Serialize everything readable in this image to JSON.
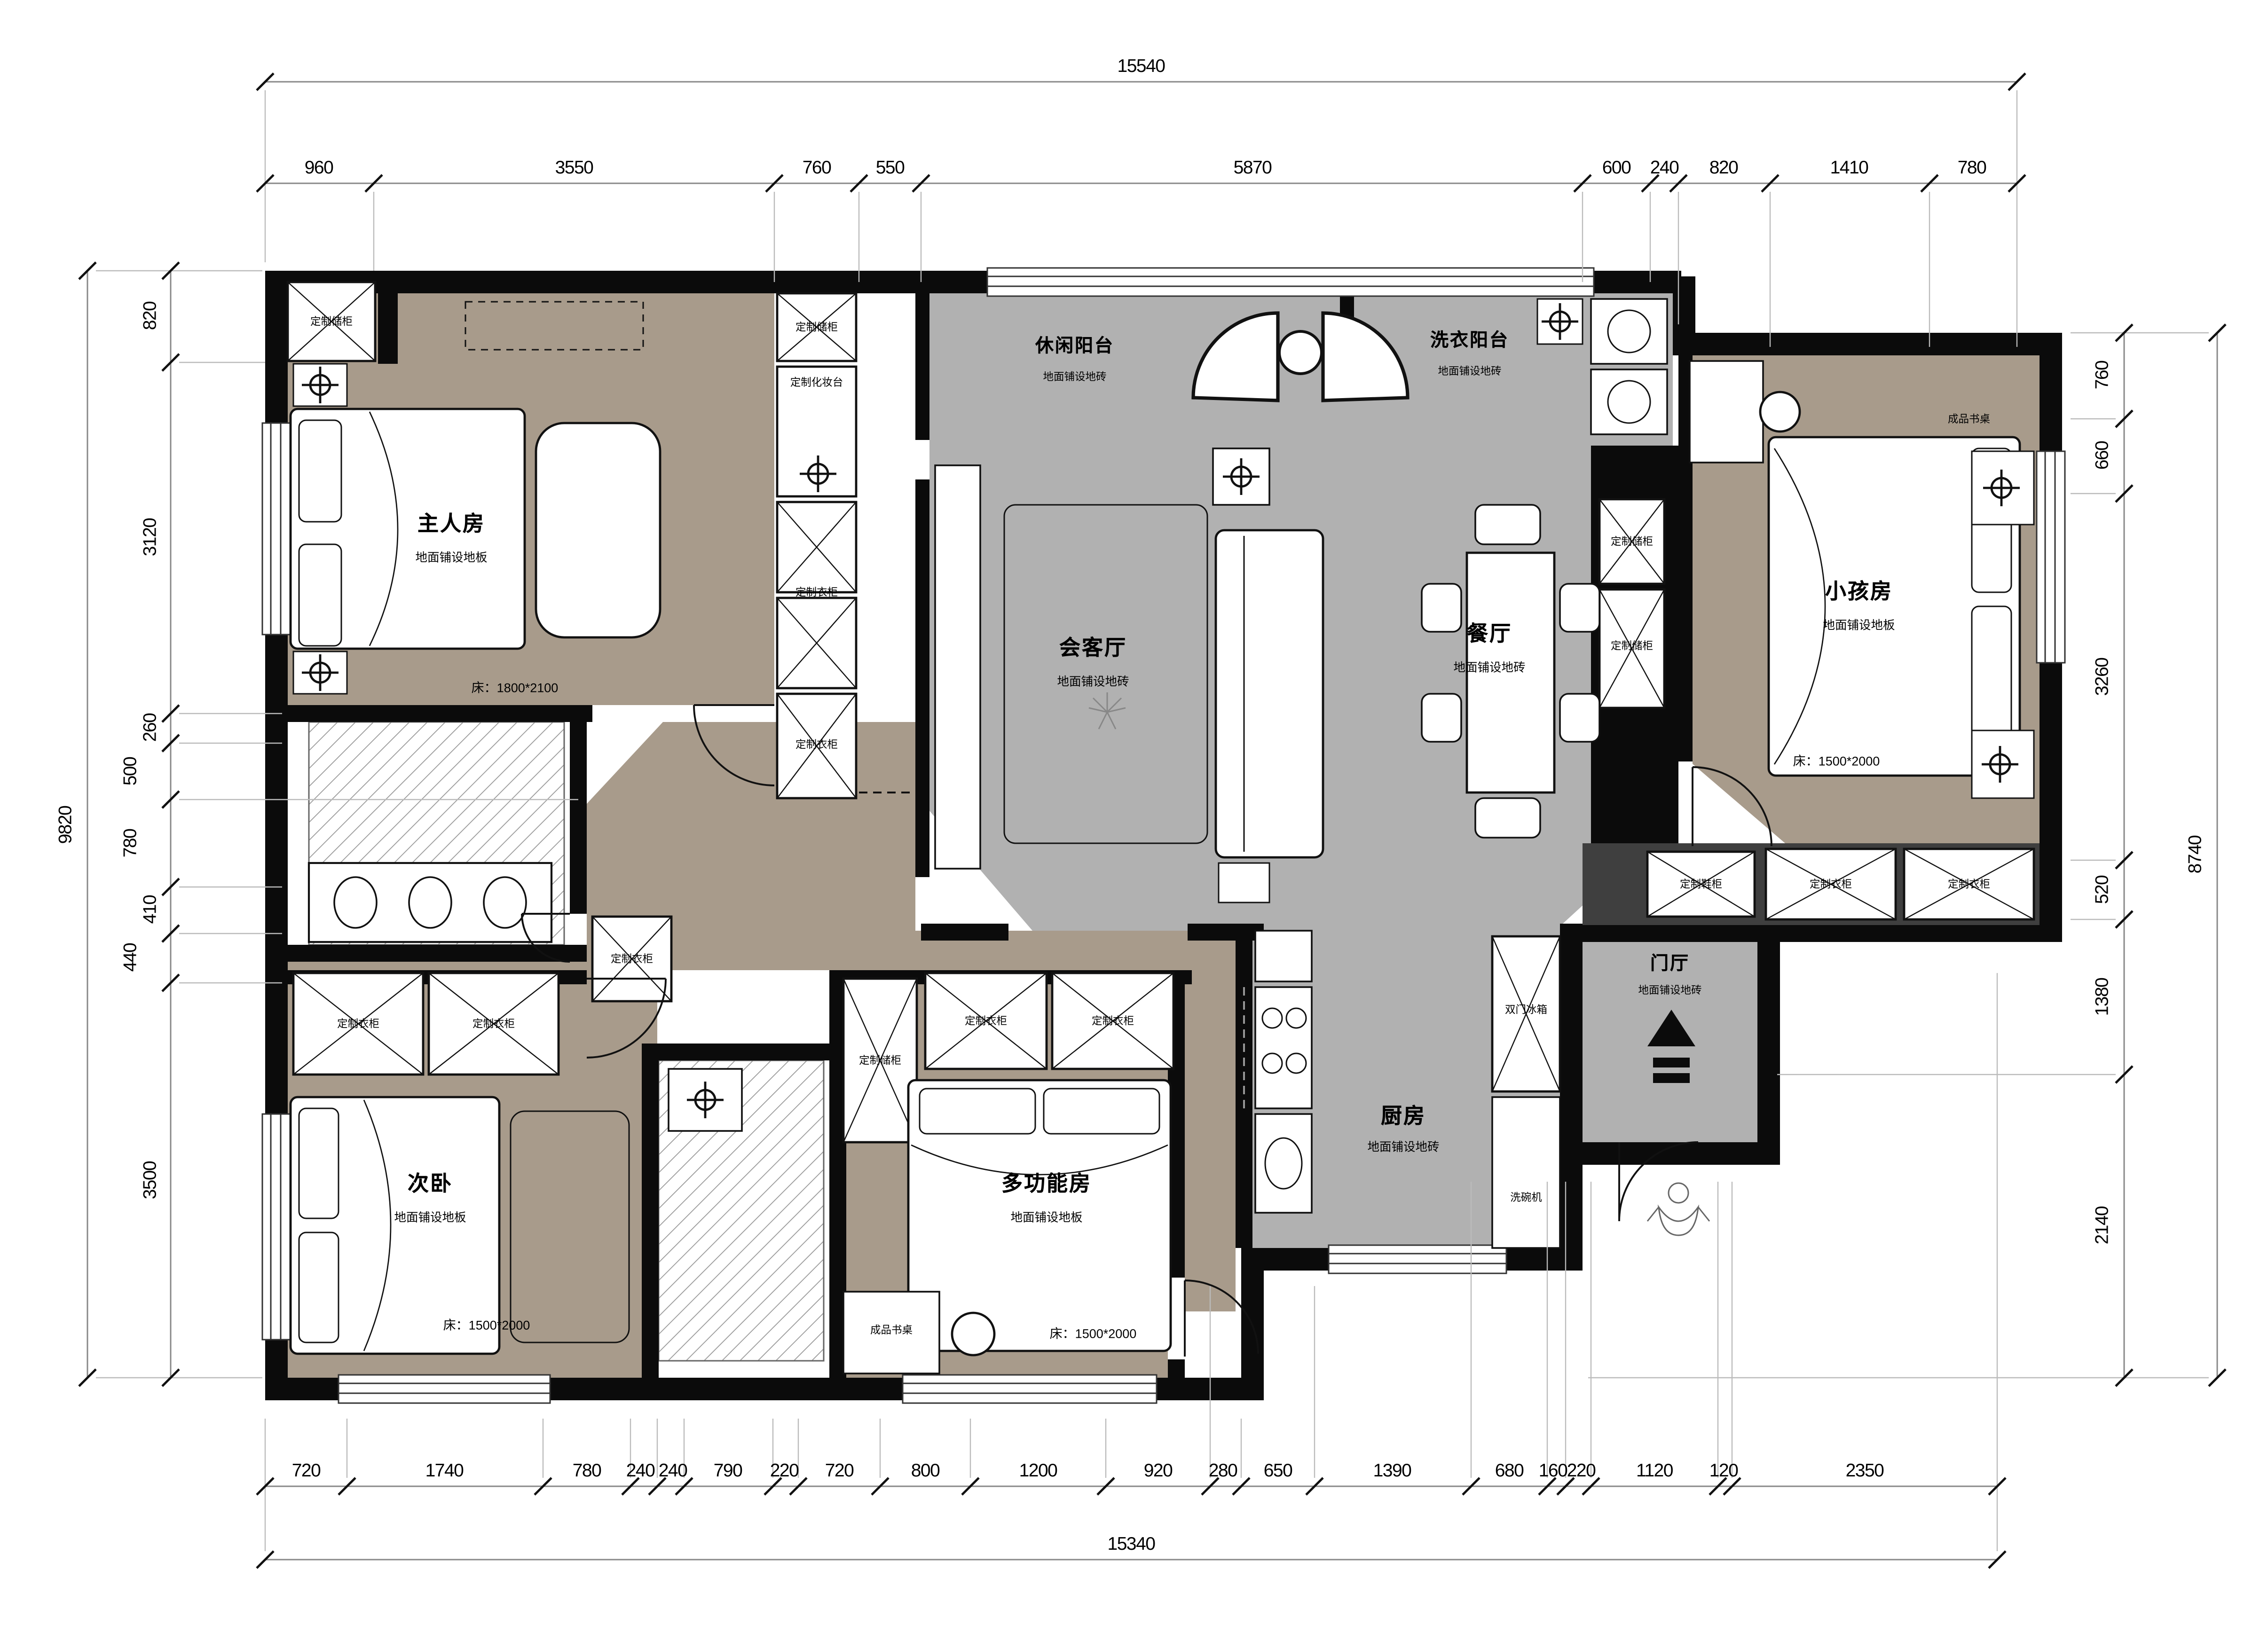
{
  "drawing": {
    "type": "floor-plan",
    "colors": {
      "wall": "#0b0b0b",
      "tile_floor": "#b1b1b1",
      "wood_floor": "#a89b8b",
      "cabinet_wall": "#3f3f3f"
    }
  },
  "dimensions": {
    "top": {
      "total": "15540",
      "segments": [
        "960",
        "3550",
        "760",
        "550",
        "5870",
        "600",
        "240",
        "820",
        "1410",
        "780"
      ]
    },
    "bottom": {
      "total": "15340",
      "segments": [
        "720",
        "1740",
        "780",
        "240",
        "240",
        "790",
        "220",
        "720",
        "800",
        "1200",
        "920",
        "280",
        "650",
        "1390",
        "680",
        "160",
        "220",
        "1120",
        "120",
        "2350"
      ]
    },
    "left": {
      "total": "9820",
      "segments": [
        "820",
        "3120",
        "260",
        "500",
        "780",
        "410",
        "440",
        "3500"
      ]
    },
    "right": {
      "total": "8740",
      "segments": [
        "760",
        "660",
        "3260",
        "520",
        "1380",
        "2140"
      ]
    }
  },
  "rooms": {
    "master": {
      "name": "主人房",
      "floor": "地面铺设地板",
      "bed": "床：1800*2100"
    },
    "second": {
      "name": "次卧",
      "floor": "地面铺设地板",
      "bed": "床：1500*2000"
    },
    "multi": {
      "name": "多功能房",
      "floor": "地面铺设地板",
      "bed": "床：1500*2000"
    },
    "kids": {
      "name": "小孩房",
      "floor": "地面铺设地板",
      "bed": "床：1500*2000"
    },
    "living": {
      "name": "会客厅",
      "floor": "地面铺设地砖"
    },
    "dining": {
      "name": "餐厅",
      "floor": "地面铺设地砖"
    },
    "kitchen": {
      "name": "厨房",
      "floor": "地面铺设地砖"
    },
    "foyer": {
      "name": "门厅",
      "floor": "地面铺设地砖"
    },
    "leisure_balcony": {
      "name": "休闲阳台",
      "floor": "地面铺设地砖"
    },
    "laundry_balcony": {
      "name": "洗衣阳台",
      "floor": "地面铺设地砖"
    }
  },
  "fixtures": {
    "storage": "定制储柜",
    "wardrobe": "定制衣柜",
    "vanity": "定制化妆台",
    "shoe": "定制鞋柜",
    "desk": "成品书桌",
    "fridge": "双门冰箱",
    "dishwasher": "洗碗机"
  }
}
